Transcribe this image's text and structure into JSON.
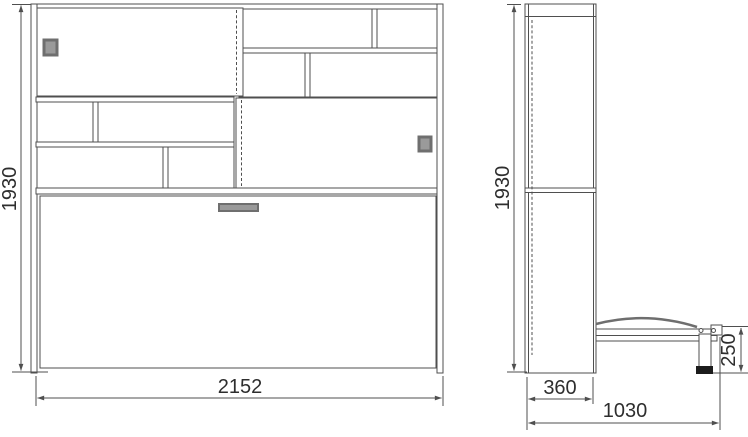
{
  "colors": {
    "background": "#ffffff",
    "line": "#4f4f4f",
    "dim_text": "#2e2e2e",
    "handle_fill": "#9a9a9a",
    "handle_border": "#6f6f6f",
    "mattress_line": "#6e6e6e",
    "foot_fill": "#1c1c1c"
  },
  "front_view": {
    "height_mm": "1930",
    "width_mm": "2152"
  },
  "side_view": {
    "height_mm": "1930",
    "depth_mm": "360",
    "bed_length_mm": "1030",
    "bed_height_mm": "250"
  }
}
